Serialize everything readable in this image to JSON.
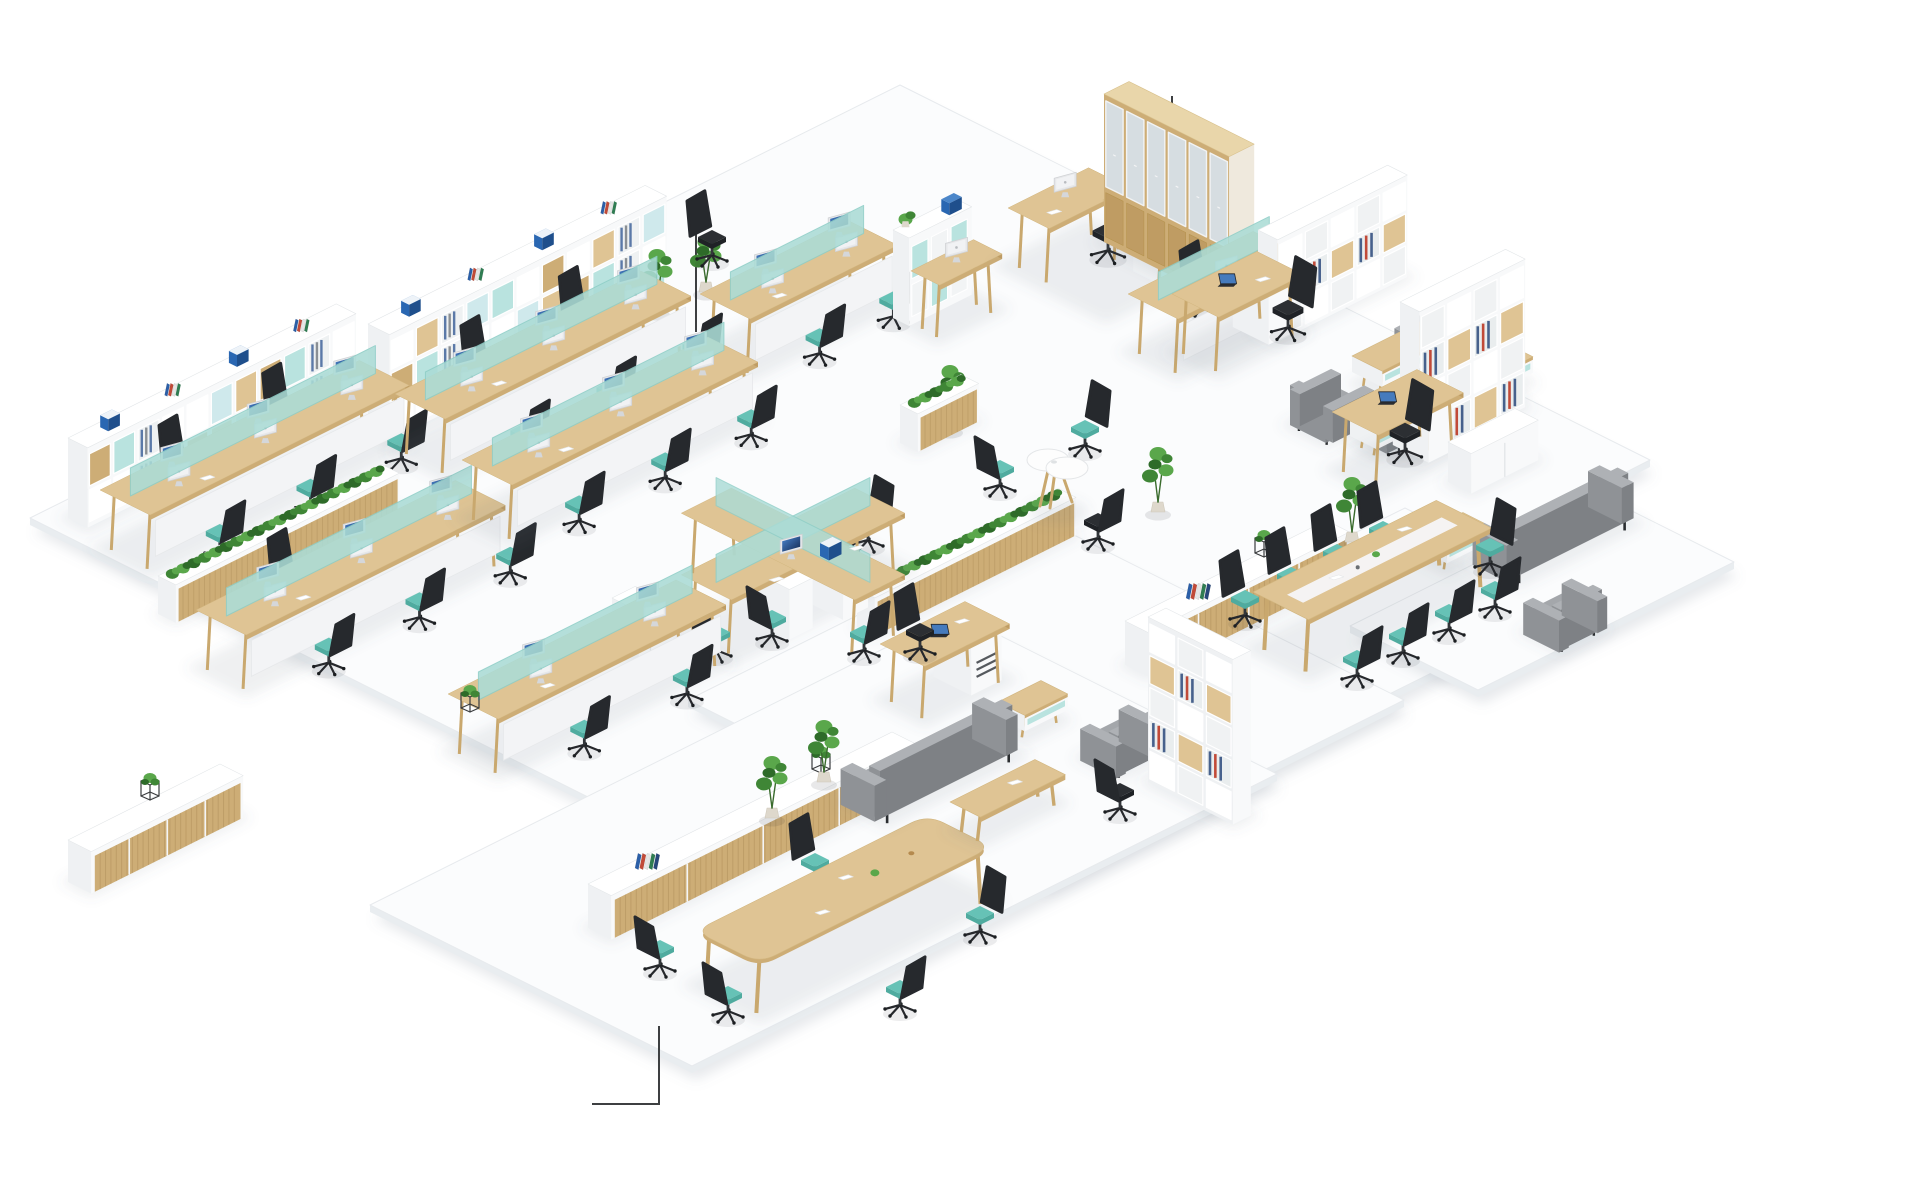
{
  "meta": {
    "label": "Isometric 3D render of an open-plan office floor with workstations, lounges and meeting areas",
    "canvas": {
      "w": 1906,
      "h": 1200
    }
  },
  "palette": {
    "floor": "#fbfcfd",
    "floorSide": "#e9edf0",
    "floorLine": "#e7eaed",
    "floorShadow": "rgba(120,135,150,0.18)",
    "woodTop": "#dfc494",
    "woodFront": "#cdad76",
    "woodSide": "#bf9c63",
    "woodLight": "#e9d6aa",
    "leg": "#c9a86e",
    "white": "#ffffff",
    "whiteL": "#eff1f3",
    "whiteR": "#f8f9fa",
    "whiteEdge": "#e4e7e9",
    "tealScreen": "#abdcd6",
    "tealScreenEdge": "#8ecec7",
    "tealSeatTop": "#66c2b6",
    "tealSeatSide": "#4fab9f",
    "tealCell": "#b9e3df",
    "tealCell2": "#cfe9ec",
    "chairDark": "#26292d",
    "chairDarker": "#1d2024",
    "chairPost": "#33363a",
    "sofaTop": "#a4a7ab",
    "sofaFront": "#8f9296",
    "sofaSide": "#7e8185",
    "green1": "#3f8636",
    "green2": "#5aa74b",
    "green3": "#2e6b29",
    "glass": "#d6dde1",
    "screenHi": "#4b86d2",
    "screenLo": "#12284f",
    "binders": [
      "#2b5fa8",
      "#c14a38",
      "#e6e6e6",
      "#2f7d52",
      "#27477a",
      "#d9d9d9"
    ],
    "fileBlue": "#2a67b2",
    "fileBlueTop": "#4b86c9",
    "callout": "#3d3f41",
    "grille": "#55595e",
    "pot": "#ded8cc"
  },
  "scene": {
    "floor_slabs": [
      {
        "name": "floor-slab-main",
        "pts": [
          [
            30,
            518
          ],
          [
            900,
            85
          ],
          [
            1650,
            460
          ],
          [
            790,
            898
          ]
        ]
      },
      {
        "name": "floor-slab-meeting-right",
        "pts": [
          [
            1060,
            680
          ],
          [
            1405,
            508
          ],
          [
            1584,
            597
          ],
          [
            1239,
            769
          ]
        ]
      },
      {
        "name": "floor-slab-lounge-right",
        "pts": [
          [
            1350,
            626
          ],
          [
            1606,
            498
          ],
          [
            1734,
            562
          ],
          [
            1478,
            690
          ]
        ]
      },
      {
        "name": "floor-slab-bottom-right",
        "pts": [
          [
            688,
            700
          ],
          [
            1046,
            521
          ],
          [
            1404,
            700
          ],
          [
            1046,
            879
          ]
        ]
      },
      {
        "name": "floor-slab-bottom-left",
        "pts": [
          [
            370,
            905
          ],
          [
            955,
            613
          ],
          [
            1277,
            774
          ],
          [
            692,
            1066
          ]
        ]
      }
    ],
    "callouts": [
      {
        "name": "callout-line-shelving",
        "pts": [
          [
            696,
            218
          ],
          [
            696,
            332
          ]
        ]
      },
      {
        "name": "callout-line-cabinet",
        "pts": [
          [
            1172,
            96
          ],
          [
            1172,
            133
          ]
        ]
      },
      {
        "name": "callout-line-meeting",
        "pts": [
          [
            592,
            1104
          ],
          [
            659,
            1104
          ],
          [
            659,
            1026
          ]
        ]
      }
    ],
    "furniture": [
      {
        "t": "plant",
        "n": "potted-plant",
        "x": 308,
        "y": 428,
        "h": 52
      },
      {
        "t": "shelf_wall",
        "n": "shelving-wall-long",
        "x": 368,
        "y": 430,
        "len": 310,
        "dep": 24,
        "h": 106,
        "rows": 3
      },
      {
        "t": "plant",
        "n": "potted-plant",
        "x": 657,
        "y": 312,
        "h": 56
      },
      {
        "t": "plant",
        "n": "potted-plant",
        "x": 706,
        "y": 292,
        "h": 50
      },
      {
        "t": "chair",
        "n": "office-chair",
        "x": 712,
        "y": 262,
        "f": "SE",
        "seat": "black"
      },
      {
        "t": "bench_row",
        "n": "workstation-bench",
        "x": 700,
        "y": 352,
        "len": 165,
        "mon": 2,
        "se": [
          0.35,
          0.85
        ],
        "nw": []
      },
      {
        "t": "hutch_desk",
        "n": "hutch-desk",
        "x": 893,
        "y": 318
      },
      {
        "t": "l_desk",
        "n": "manager-l-desk",
        "x": 1008,
        "y": 266
      },
      {
        "t": "chair",
        "n": "office-chair",
        "x": 1108,
        "y": 258,
        "f": "SW",
        "seat": "black",
        "s": 1.1
      },
      {
        "t": "tall_cabinet",
        "n": "glass-door-cabinet",
        "x": 1104,
        "y": 242,
        "len": 140,
        "dep": 28,
        "h": 148
      },
      {
        "t": "chair",
        "n": "office-chair",
        "x": 1205,
        "y": 312,
        "f": "SE"
      },
      {
        "t": "chair",
        "n": "office-chair",
        "x": 1262,
        "y": 322,
        "f": "SE"
      },
      {
        "t": "bench_row",
        "n": "workstation-bench",
        "x": 1128,
        "y": 352,
        "len": 140,
        "mon": 1,
        "se": [],
        "nw": []
      },
      {
        "t": "bookshelf",
        "n": "bookshelf",
        "x": 1258,
        "y": 332,
        "len": 145,
        "dep": 22,
        "h": 102,
        "axis": "NE"
      },
      {
        "t": "exec_desk",
        "n": "executive-desk",
        "x": 1172,
        "y": 352
      },
      {
        "t": "chair",
        "n": "office-chair",
        "x": 1288,
        "y": 335,
        "f": "SW",
        "seat": "black",
        "s": 1.1
      },
      {
        "t": "armchair",
        "n": "lounge-armchair",
        "x": 1398,
        "y": 362,
        "f": "SW"
      },
      {
        "t": "coffee_table",
        "n": "coffee-table",
        "x": 1352,
        "y": 384,
        "len": 78
      },
      {
        "t": "side_table",
        "n": "side-table",
        "x": 1465,
        "y": 390,
        "len": 46
      },
      {
        "t": "sofa",
        "n": "lounge-sofa",
        "x": 1358,
        "y": 434,
        "len": 128
      },
      {
        "t": "armchair",
        "n": "lounge-armchair",
        "x": 1290,
        "y": 425,
        "f": "NE"
      },
      {
        "t": "side_table",
        "n": "side-table",
        "x": 1350,
        "y": 446,
        "len": 50
      },
      {
        "t": "bookshelf",
        "n": "tall-bookcase",
        "x": 1400,
        "y": 450,
        "len": 118,
        "dep": 22,
        "h": 148,
        "axis": "NE"
      },
      {
        "t": "exec_desk",
        "n": "executive-desk",
        "x": 1332,
        "y": 470
      },
      {
        "t": "chair",
        "n": "office-chair",
        "x": 1405,
        "y": 458,
        "f": "SW",
        "seat": "black",
        "s": 1.1
      },
      {
        "t": "credenza",
        "n": "low-cabinet",
        "x": 1448,
        "y": 482,
        "len": 75,
        "h": 40,
        "style": "white"
      },
      {
        "t": "side_table",
        "n": "side-table",
        "x": 1420,
        "y": 560,
        "len": 48
      },
      {
        "t": "sofa",
        "n": "lounge-sofa",
        "x": 1478,
        "y": 562,
        "len": 130
      },
      {
        "t": "armchair",
        "n": "lounge-armchair",
        "x": 1525,
        "y": 632,
        "f": "NW"
      },
      {
        "t": "shelf_wall",
        "n": "storage-wall",
        "x": 68,
        "y": 518,
        "len": 300,
        "dep": 22,
        "h": 80,
        "rows": 2
      },
      {
        "t": "bench_row",
        "n": "workstation-bench",
        "x": 100,
        "y": 548,
        "len": 290,
        "mon": 3,
        "se": [
          0.2,
          0.55,
          0.9
        ],
        "nw": [
          0.4,
          0.8
        ]
      },
      {
        "t": "planter_wall",
        "n": "planter-cabinet",
        "x": 158,
        "y": 614,
        "len": 250
      },
      {
        "t": "bench_row",
        "n": "workstation-bench",
        "x": 196,
        "y": 668,
        "len": 290,
        "mon": 3,
        "se": [
          0.25,
          0.6,
          0.95
        ],
        "nw": [
          0.45
        ]
      },
      {
        "t": "bench_row",
        "n": "workstation-bench",
        "x": 395,
        "y": 452,
        "len": 275,
        "mon": 3,
        "se": [
          0.25,
          0.6,
          0.95
        ],
        "nw": [
          0.45,
          0.85
        ]
      },
      {
        "t": "bench_row",
        "n": "workstation-bench",
        "x": 462,
        "y": 518,
        "len": 275,
        "mon": 3,
        "se": [
          0.2,
          0.55,
          0.9
        ],
        "nw": []
      },
      {
        "t": "plant",
        "n": "potted-plant",
        "x": 950,
        "y": 430,
        "h": 58
      },
      {
        "t": "planter_wall",
        "n": "planter-cabinet",
        "x": 900,
        "y": 443,
        "len": 68
      },
      {
        "t": "chair",
        "n": "office-chair",
        "x": 868,
        "y": 547,
        "f": "SW"
      },
      {
        "t": "planter_wall",
        "n": "planter-cabinet",
        "x": 857,
        "y": 627,
        "len": 225
      },
      {
        "t": "pedestal",
        "n": "mobile-pedestal",
        "x": 612,
        "y": 648
      },
      {
        "t": "plant_cube",
        "n": "cube-planter",
        "x": 620,
        "y": 636
      },
      {
        "t": "pinwheel",
        "n": "pinwheel-workstation",
        "x": 793,
        "y": 602
      },
      {
        "t": "chair",
        "n": "office-chair",
        "x": 716,
        "y": 657,
        "f": "NE"
      },
      {
        "t": "chair",
        "n": "office-chair",
        "x": 864,
        "y": 657,
        "f": "NW"
      },
      {
        "t": "file_box",
        "n": "file-box",
        "x": 820,
        "y": 556
      },
      {
        "t": "bench_row",
        "n": "workstation-bench",
        "x": 448,
        "y": 752,
        "len": 255,
        "mon": 2,
        "se": [
          0.3,
          0.75
        ],
        "nw": []
      },
      {
        "t": "plant_cube",
        "n": "cube-planter",
        "x": 470,
        "y": 712
      },
      {
        "t": "chair",
        "n": "office-chair",
        "x": 1085,
        "y": 452,
        "f": "SW"
      },
      {
        "t": "peanut_table",
        "n": "meeting-nook-table",
        "x": 1048,
        "y": 498
      },
      {
        "t": "chair",
        "n": "office-chair",
        "x": 1000,
        "y": 492,
        "f": "NE"
      },
      {
        "t": "chair",
        "n": "office-chair",
        "x": 1098,
        "y": 545,
        "f": "NW",
        "seat": "black"
      },
      {
        "t": "plant",
        "n": "potted-plant",
        "x": 1158,
        "y": 512,
        "h": 58
      },
      {
        "t": "credenza",
        "n": "sliding-door-credenza",
        "x": 1125,
        "y": 665,
        "len": 225,
        "h": 44,
        "style": "wood"
      },
      {
        "t": "binders",
        "n": "binder-row",
        "x": 1186,
        "y": 598
      },
      {
        "t": "plant_cube",
        "n": "cube-planter",
        "x": 1264,
        "y": 557
      },
      {
        "t": "plant",
        "n": "potted-plant",
        "x": 1352,
        "y": 542,
        "h": 58
      },
      {
        "t": "chair",
        "n": "conference-chair",
        "x": 1245,
        "y": 622,
        "f": "SE"
      },
      {
        "t": "chair",
        "n": "conference-chair",
        "x": 1291,
        "y": 599,
        "f": "SE"
      },
      {
        "t": "chair",
        "n": "conference-chair",
        "x": 1337,
        "y": 576,
        "f": "SE"
      },
      {
        "t": "chair",
        "n": "conference-chair",
        "x": 1383,
        "y": 553,
        "f": "SE"
      },
      {
        "t": "conf_table",
        "n": "conference-table",
        "x": 1253,
        "y": 648,
        "len": 205,
        "dep": 62
      },
      {
        "t": "chair",
        "n": "conference-chair",
        "x": 1490,
        "y": 570,
        "f": "SW"
      },
      {
        "t": "chair",
        "n": "conference-chair",
        "x": 1357,
        "y": 682,
        "f": "NW"
      },
      {
        "t": "chair",
        "n": "conference-chair",
        "x": 1403,
        "y": 659,
        "f": "NW"
      },
      {
        "t": "chair",
        "n": "conference-chair",
        "x": 1449,
        "y": 636,
        "f": "NW"
      },
      {
        "t": "chair",
        "n": "conference-chair",
        "x": 1495,
        "y": 613,
        "f": "NW"
      },
      {
        "t": "credenza",
        "n": "sliding-door-credenza",
        "x": 588,
        "y": 928,
        "len": 340,
        "h": 44,
        "style": "wood"
      },
      {
        "t": "binders",
        "n": "binder-row",
        "x": 635,
        "y": 868
      },
      {
        "t": "plant_cube",
        "n": "cube-planter",
        "x": 821,
        "y": 773
      },
      {
        "t": "chair",
        "n": "meeting-chair",
        "x": 815,
        "y": 885,
        "f": "SE"
      },
      {
        "t": "boat_table",
        "n": "meeting-table",
        "x": 695,
        "y": 985,
        "len": 260,
        "dep": 72
      },
      {
        "t": "chair",
        "n": "meeting-chair",
        "x": 660,
        "y": 972,
        "f": "NE"
      },
      {
        "t": "chair",
        "n": "meeting-chair",
        "x": 728,
        "y": 1018,
        "f": "NE"
      },
      {
        "t": "chair",
        "n": "meeting-chair",
        "x": 980,
        "y": 938,
        "f": "SW"
      },
      {
        "t": "chair",
        "n": "meeting-chair",
        "x": 900,
        "y": 1012,
        "f": "NW"
      },
      {
        "t": "chair",
        "n": "office-chair",
        "x": 772,
        "y": 642,
        "f": "NE"
      },
      {
        "t": "grille_desk",
        "n": "desk-with-return",
        "x": 880,
        "y": 700
      },
      {
        "t": "chair",
        "n": "office-chair",
        "x": 920,
        "y": 655,
        "f": "SE",
        "seat": "black"
      },
      {
        "t": "side_table",
        "n": "side-table",
        "x": 998,
        "y": 728,
        "len": 48
      },
      {
        "t": "armchair",
        "n": "lounge-armchair",
        "x": 1082,
        "y": 758,
        "f": "NW"
      },
      {
        "t": "bookshelf",
        "n": "display-bookshelf",
        "x": 1148,
        "y": 782,
        "len": 95,
        "dep": 20,
        "h": 165,
        "axis": "SE"
      },
      {
        "t": "chair",
        "n": "office-chair",
        "x": 1120,
        "y": 815,
        "f": "NE",
        "seat": "black"
      },
      {
        "t": "sofa",
        "n": "lounge-sofa",
        "x": 846,
        "y": 802,
        "len": 148
      },
      {
        "t": "bench_table",
        "n": "wood-bench-table",
        "x": 950,
        "y": 830,
        "len": 95
      },
      {
        "t": "plant",
        "n": "potted-plant",
        "x": 772,
        "y": 818,
        "h": 55
      },
      {
        "t": "plant",
        "n": "potted-plant",
        "x": 824,
        "y": 782,
        "h": 55
      },
      {
        "t": "credenza",
        "n": "low-cabinet",
        "x": 68,
        "y": 882,
        "len": 170,
        "h": 42,
        "style": "wood"
      },
      {
        "t": "plant_cube",
        "n": "cube-planter",
        "x": 150,
        "y": 800
      }
    ]
  }
}
